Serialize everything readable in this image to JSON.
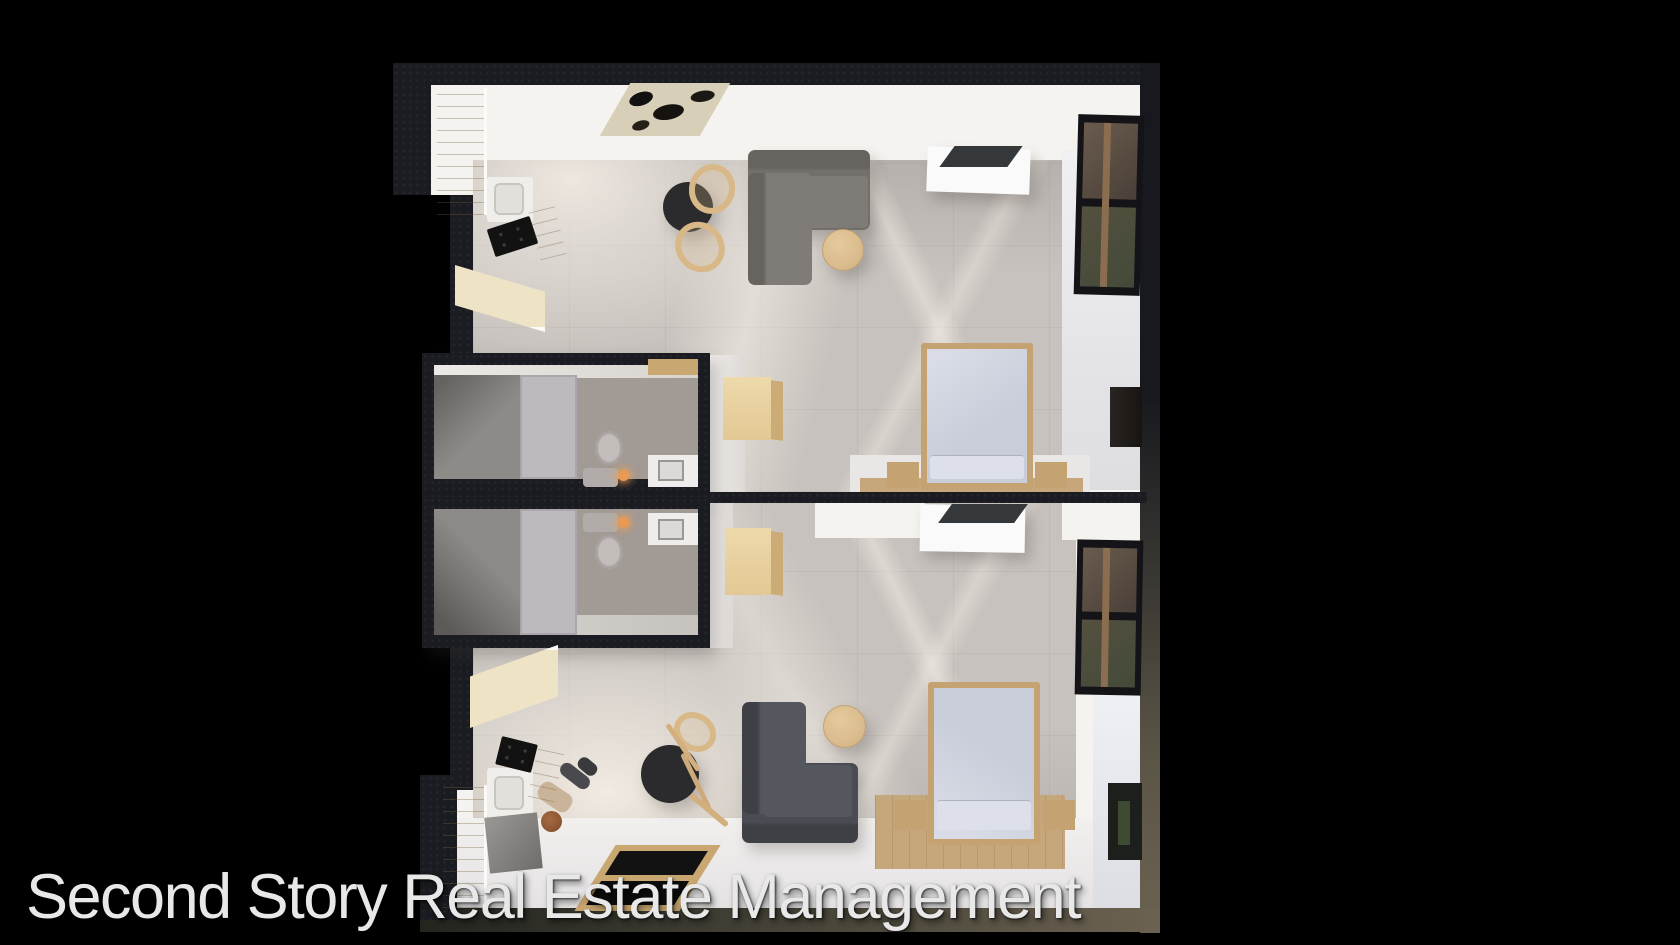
{
  "watermark": {
    "text": "Second Story Real Estate Management"
  },
  "scene": {
    "type": "3d-top-down-floor-plan-render",
    "description": "aerial cutaway rendering of two mirrored studio apartment units on black background",
    "units": [
      {
        "name": "upper-studio",
        "rooms": [
          "entry",
          "kitchen",
          "living-dining-area",
          "bathroom",
          "sleeping-area"
        ],
        "furniture": [
          "art-doormat",
          "kitchen-cabinets",
          "sink",
          "cooktop",
          "round-dining-table",
          "two-wood-chairs",
          "l-shaped-sofa",
          "round-coffee-table",
          "media-console-with-tv",
          "wood-cube-dresser",
          "double-bed",
          "two-nightstands",
          "wood-runner-rug",
          "toilet",
          "shower",
          "vanity-sink",
          "window-wall",
          "dark-dresser"
        ]
      },
      {
        "name": "lower-studio",
        "rooms": [
          "entry",
          "kitchen",
          "living-dining-area",
          "bathroom",
          "sleeping-area"
        ],
        "furniture": [
          "kitchen-cabinets",
          "sink",
          "cooktop",
          "gray-counter-block",
          "round-dining-table",
          "tipped-wood-chair",
          "l-shaped-sofa",
          "round-coffee-table",
          "media-console-with-tv",
          "wood-cube-dresser",
          "double-bed",
          "two-nightstands",
          "wood-area-rug",
          "toilet",
          "shower",
          "vanity-sink",
          "window-wall",
          "tv-niche",
          "standing-person",
          "framed-floor-panel"
        ]
      }
    ]
  },
  "palette": {
    "bg": "#000000",
    "wall": "#1a1c21",
    "wallBrown": "#6b6251",
    "whiteWall": "#f5f3f0",
    "floorWhite": "#eceae9",
    "concrete": "#c8c2be",
    "concreteDark": "#b3acaa",
    "wood": "#e6d2a6",
    "woodLight": "#efe3c6",
    "woodDark": "#c9a771",
    "rugWood": "#c6a77c",
    "sofaTop": "#73706b",
    "sofaTopSeat": "#7f7c77",
    "sofaBot": "#4a4c53",
    "sofaBotSeat": "#55575e",
    "tableBlack": "#2b2a2c",
    "bedWood": "#c4a271",
    "bedding": "#c9cdd9",
    "beddingLight": "#dde0e9",
    "bathTile": "#a29a95",
    "showerGray": "#8e8a88",
    "doorGray": "#bcbabd",
    "vanityWhite": "#efedec",
    "tvDark": "#34383b",
    "glass": "#5d5044",
    "glassGreen": "#434a39",
    "candle": "#e89a55",
    "watermarkColor": "#e8e8e8"
  }
}
